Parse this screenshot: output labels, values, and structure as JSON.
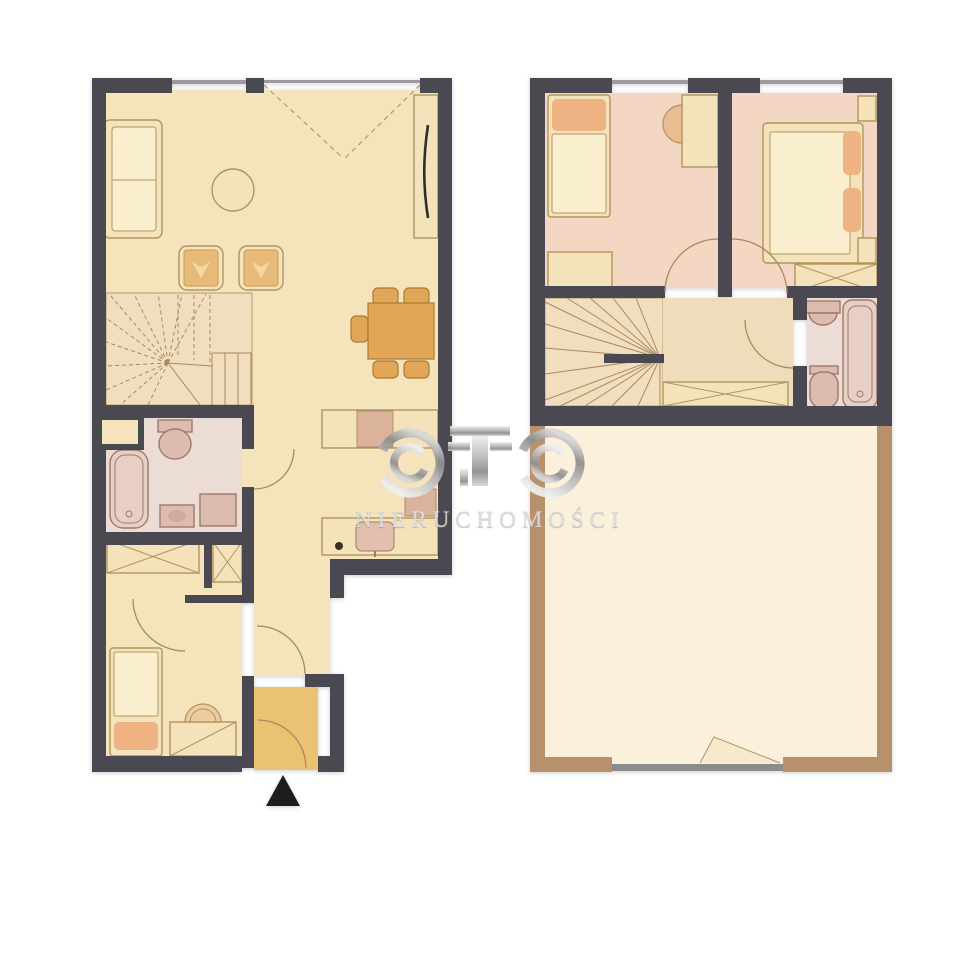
{
  "watermark": {
    "brand": "OTO",
    "subtitle": "NIERUCHOMOŚCI"
  },
  "colors": {
    "wall": "#4a4850",
    "window_gray": "#9a9aa0",
    "floor_cream": "#f5e3bb",
    "floor_stairs": "#f1debf",
    "floor_landing": "#efdcba",
    "floor_pink": "#f3d7c3",
    "floor_bath": "#ecdcd6",
    "vestibule_tan": "#eac271",
    "furn_cream": "#f3e2ba",
    "furn_cream_light": "#f9efce",
    "furn_outline": "#b2945e",
    "furn_tan": "#e2a659",
    "furn_tan_outline": "#aa7a30",
    "accent_orange": "#eeb283",
    "fixture_pink": "#ddbcb0",
    "fixture_fill": "#e7cfc6",
    "fixture_outline": "#a17868",
    "line_brown": "#a98a5c",
    "terrace_wall": "#b8906b",
    "terrace_floor": "#faf0dc",
    "slider_gray": "#8b8b8b",
    "marker_black": "#1d1d1d",
    "watermark_text": "#dcdcdc"
  },
  "plans": {
    "ground_floor": {
      "label": "ground floor",
      "rooms": [
        {
          "id": "living-room",
          "furniture": [
            "sofa",
            "coffee-table",
            "armchair-left",
            "armchair-right",
            "dining-table",
            "five-chairs",
            "tall-cabinet",
            "winder-stairs"
          ]
        },
        {
          "id": "kitchen",
          "furniture": [
            "upper-counter",
            "stove",
            "lower-counter",
            "sink",
            "dishwasher"
          ]
        },
        {
          "id": "bathroom",
          "furniture": [
            "bathtub",
            "toilet",
            "washbasin",
            "washing-machine"
          ]
        },
        {
          "id": "bedroom",
          "furniture": [
            "wardrobe",
            "closet-niche",
            "single-bed",
            "desk",
            "chair"
          ]
        },
        {
          "id": "hall",
          "furniture": []
        },
        {
          "id": "vestibule",
          "furniture": [
            "entrance-door"
          ]
        }
      ],
      "marker": "entrance-arrow"
    },
    "upper_floor": {
      "label": "upper floor",
      "rooms": [
        {
          "id": "bedroom-left",
          "furniture": [
            "single-bed",
            "desk",
            "chair",
            "cabinet"
          ]
        },
        {
          "id": "bedroom-right",
          "furniture": [
            "double-bed",
            "nightstand-top",
            "nightstand-bottom",
            "wardrobe"
          ]
        },
        {
          "id": "landing",
          "furniture": [
            "winder-stairs",
            "handrail",
            "wardrobe"
          ]
        },
        {
          "id": "bathroom",
          "furniture": [
            "washbasin",
            "toilet",
            "bathtub"
          ]
        },
        {
          "id": "terrace",
          "furniture": [
            "sliding-door"
          ]
        }
      ]
    }
  }
}
